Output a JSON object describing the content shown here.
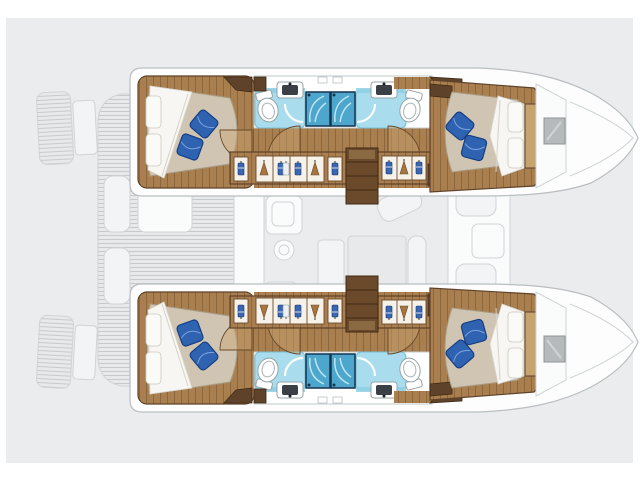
{
  "image": {
    "kind": "boat floor plan",
    "vessel": "catamaran",
    "view": "top-down interior layout, cabins highlighted in color over a ghosted deck drawing"
  },
  "hulls": {
    "top_hull": {
      "rooms": [
        "aft-double-cabin",
        "aft-bathroom-with-shower",
        "forward-bathroom-with-shower",
        "corridor-with-wardrobes",
        "forward-double-cabin"
      ],
      "features": [
        "double-bed-white-duvet",
        "two-blue-pillows-per-bed",
        "companionway-steps",
        "hanging-lockers-with-clothes",
        "toilet",
        "sink",
        "shower-cabins",
        "bow-deck-hatch"
      ]
    },
    "bottom_hull": {
      "mirrors": "top_hull"
    }
  },
  "center_ghosted": {
    "features": [
      "swim-platforms",
      "aft-deck-with-planking",
      "cockpit-table",
      "cockpit-benches",
      "saloon-galley-sink",
      "stove-burner",
      "galley-island",
      "dining-table",
      "saloon-benches",
      "forward-cockpit-seats",
      "forward-cockpit-table"
    ]
  },
  "colors": {
    "canvas": "#eaeced",
    "ghostFill": "#f3f4f5",
    "ghostLight": "#fafbfb",
    "ghostStroke": "#d0d4d6",
    "ghostDeck": "#e7e9ea",
    "hullWhite": "#fdfdfd",
    "hullStroke": "#b9bec0",
    "wood": "#a97f50",
    "woodLight": "#c9a36f",
    "woodDark": "#5e432a",
    "mattress": "#cfc5b2",
    "duvet": "#f7f6f2",
    "pillowBlue": "#2f63b2",
    "pillowBlueDark": "#173f83",
    "bathFloor": "#a9dcec",
    "showerBlue": "#4da6cc",
    "showerTrim": "#16324e",
    "basinDark": "#3a4045",
    "hatchGray": "#b6babd"
  }
}
